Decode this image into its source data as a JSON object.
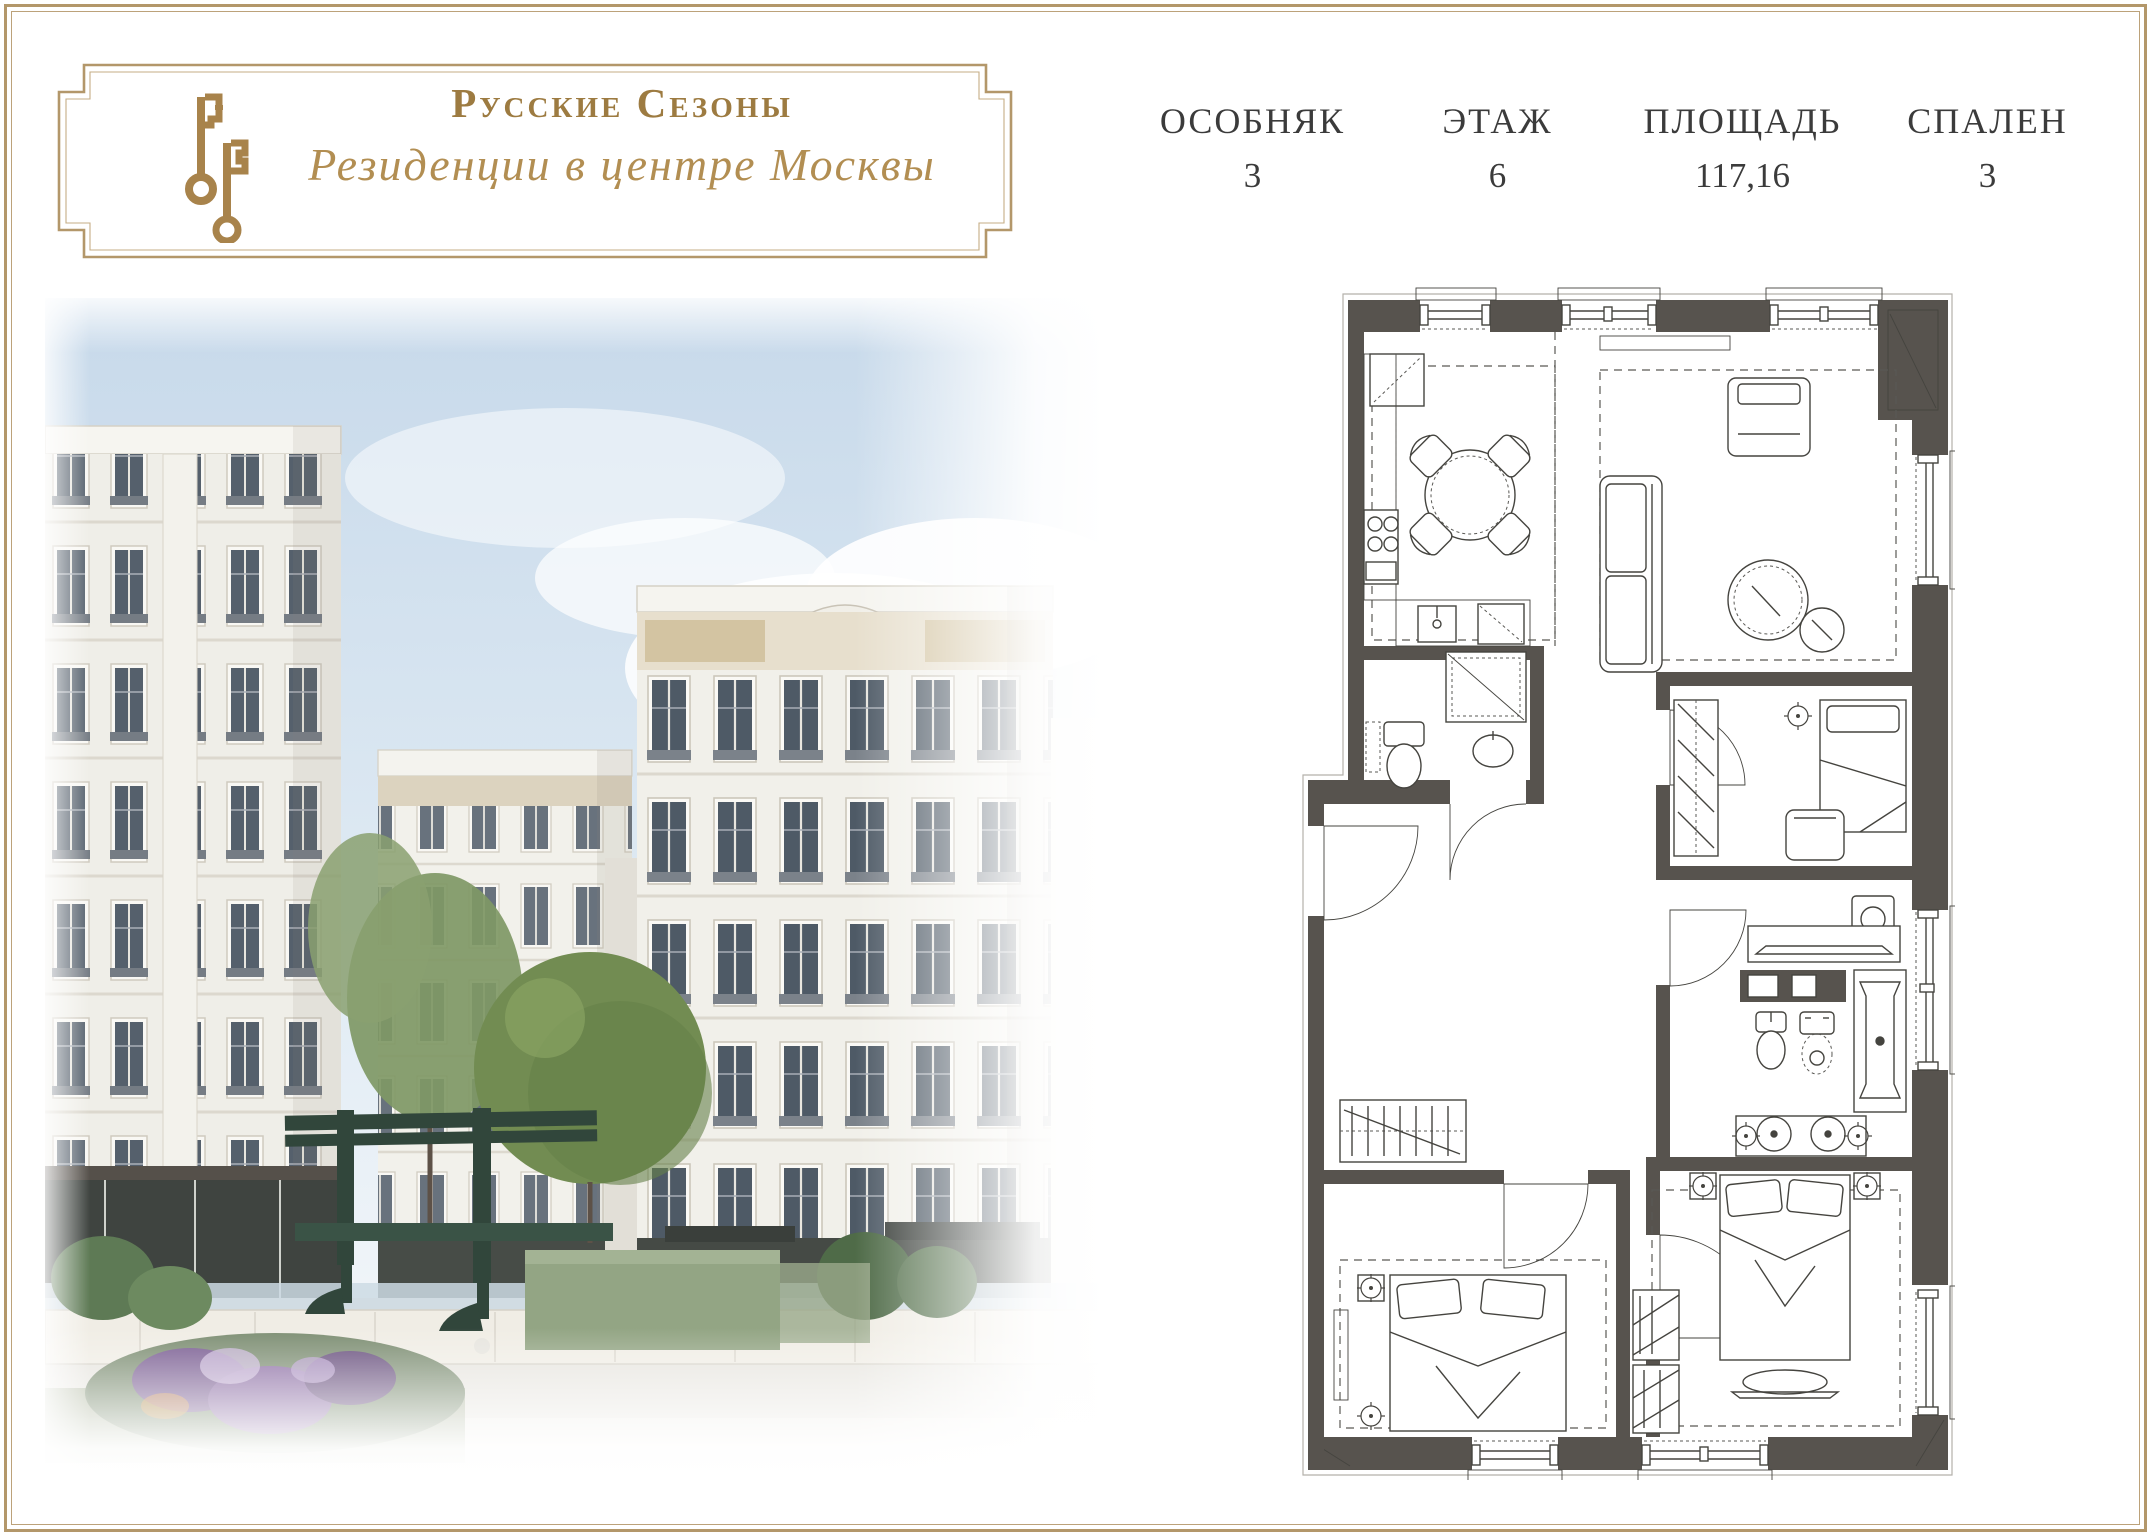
{
  "page": {
    "background": "#ffffff",
    "border_color": "#b3976a"
  },
  "brand": {
    "title": "Русские Сезоны",
    "subtitle": "Резиденции в центре Москвы",
    "logo_icon": "double-keys-icon",
    "gold": "#a8834b"
  },
  "specs": {
    "columns": [
      {
        "label": "ОСОБНЯК",
        "value": "3"
      },
      {
        "label": "ЭТАЖ",
        "value": "6"
      },
      {
        "label": "ПЛОЩАДЬ",
        "value": "117,16"
      },
      {
        "label": "СПАЛЕН",
        "value": "3"
      }
    ]
  },
  "floor_plan": {
    "wall_color": "#57534e",
    "line_color": "#45443f"
  },
  "rendering_palette": {
    "sky": "#cfdeec",
    "facade": "#efeee8",
    "bench_green": "#31463b",
    "tree_green": "#728c52",
    "flower_purple": "#8d6fa5"
  }
}
